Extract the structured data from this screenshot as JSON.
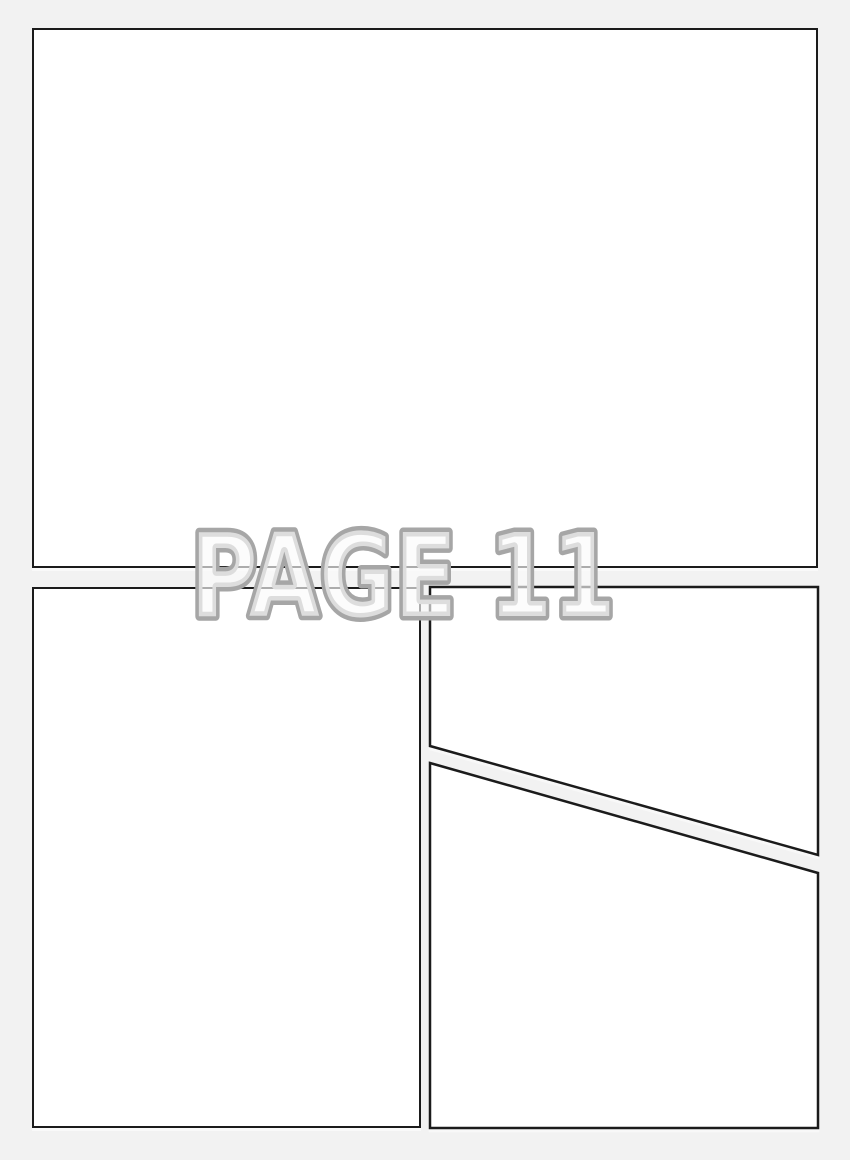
{
  "title": {
    "label": "PAGE 11"
  },
  "page": {
    "type": "blank-comic-page-template",
    "panel_count": 4
  },
  "colors": {
    "background": "#f2f2f2",
    "panel_fill": "#ffffff",
    "panel_border": "#1b1b1b",
    "title_outline": "#a6a6a6",
    "title_fill": "rgba(250,250,250,0.65)"
  }
}
